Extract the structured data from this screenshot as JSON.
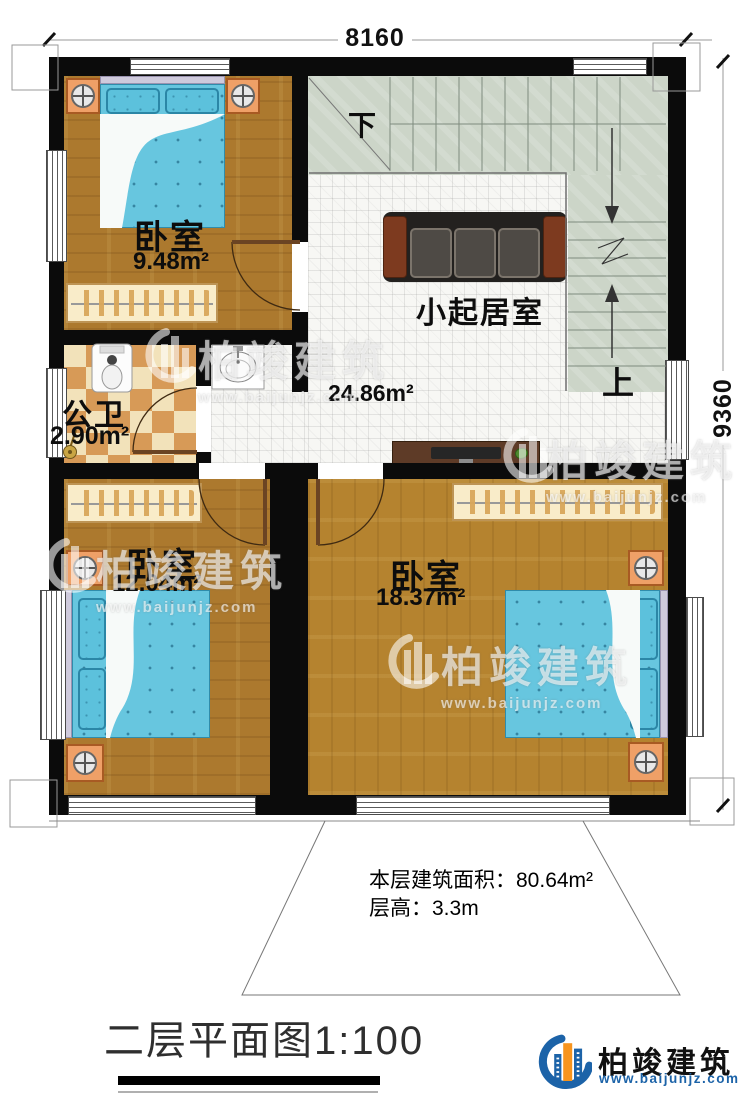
{
  "dimensions": {
    "top": "8160",
    "right": "9360"
  },
  "rooms": {
    "bedroom_top": {
      "name": "卧室",
      "area": "9.48m²"
    },
    "bedroom_left": {
      "name": "卧室",
      "area": "12.04m²"
    },
    "bedroom_right": {
      "name": "卧室",
      "area": "18.37m²"
    },
    "bathroom": {
      "name": "公卫",
      "area": "2.90m²"
    },
    "living": {
      "name": "小起居室",
      "area": "24.86m²"
    }
  },
  "stairs": {
    "down": "下",
    "up": "上"
  },
  "notes": {
    "area_line": "本层建筑面积：80.64m²",
    "height_line": "层高：3.3m"
  },
  "title": "二层平面图1:100",
  "brand": {
    "name": "柏竣建筑",
    "url": "www.baijunjz.com"
  },
  "watermark": {
    "name": "柏竣建筑",
    "url": "www.baijunjz.com"
  },
  "colors": {
    "wall": "#0b0b0b",
    "wood_floor": "#ac792e",
    "tile_floor": "#f7f7f4",
    "stair": "#ccd5c8",
    "bed_blue": "#67c6df",
    "bathroom_tan": "#d79a57",
    "brand_blue": "#1c63a8",
    "brand_orange": "#f7941d"
  }
}
